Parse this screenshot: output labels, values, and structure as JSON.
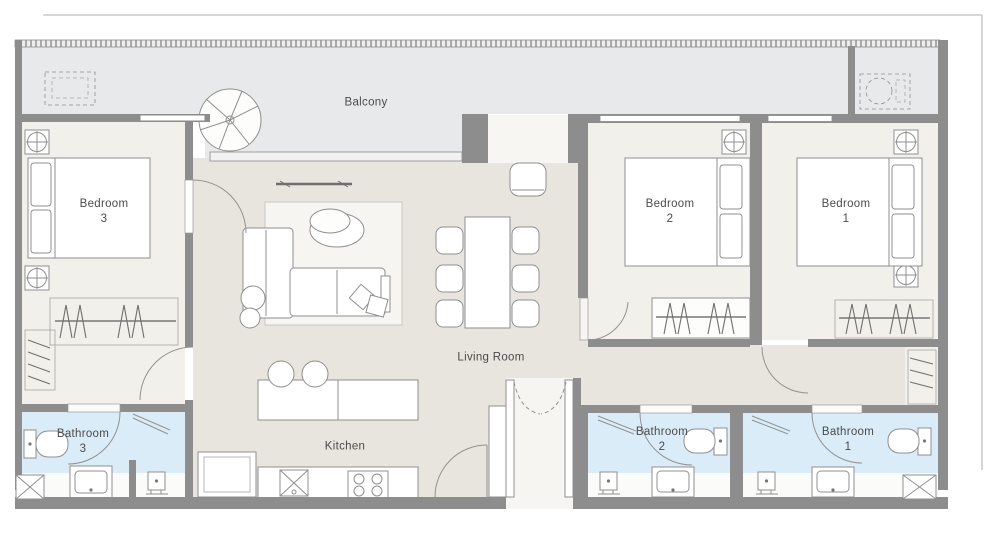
{
  "plan": {
    "type": "apartment-floor-plan",
    "colors": {
      "wall": "#8d8d8d",
      "balcony_floor": "#e8e9eb",
      "interior_floor": "#e8e5de",
      "bedroom_floor": "#f2f0ea",
      "bathroom_floor": "#d9ecf8",
      "fixture_band": "#fbfbfa",
      "label_text": "#4b4b4b",
      "frame_line": "#adadad"
    },
    "rooms": {
      "balcony": {
        "label": "Balcony"
      },
      "bedroom_3": {
        "label": "Bedroom",
        "number": "3"
      },
      "bedroom_2": {
        "label": "Bedroom",
        "number": "2"
      },
      "bedroom_1": {
        "label": "Bedroom",
        "number": "1"
      },
      "living_room": {
        "label": "Living Room"
      },
      "kitchen": {
        "label": "Kitchen"
      },
      "bathroom_3": {
        "label": "Bathroom",
        "number": "3"
      },
      "bathroom_2": {
        "label": "Bathroom",
        "number": "2"
      },
      "bathroom_1": {
        "label": "Bathroom",
        "number": "1"
      }
    },
    "icons": {
      "furniture": [
        "double-bed",
        "pillow",
        "ceiling-diffuser",
        "wardrobe-hangers",
        "shoe-shelves",
        "sofa",
        "pouf",
        "cushion",
        "coffee-table",
        "tv-console",
        "rug",
        "dining-table",
        "dining-chair",
        "bar-stool",
        "kitchen-island",
        "fridge",
        "kitchen-sink",
        "stove",
        "toilet",
        "vanity-sink",
        "floor-drain",
        "shower-door",
        "door-swing",
        "double-entry-door",
        "service-shaft",
        "balcony-planter",
        "potted-plant",
        "bbq-grill",
        "window",
        "railing"
      ]
    }
  }
}
